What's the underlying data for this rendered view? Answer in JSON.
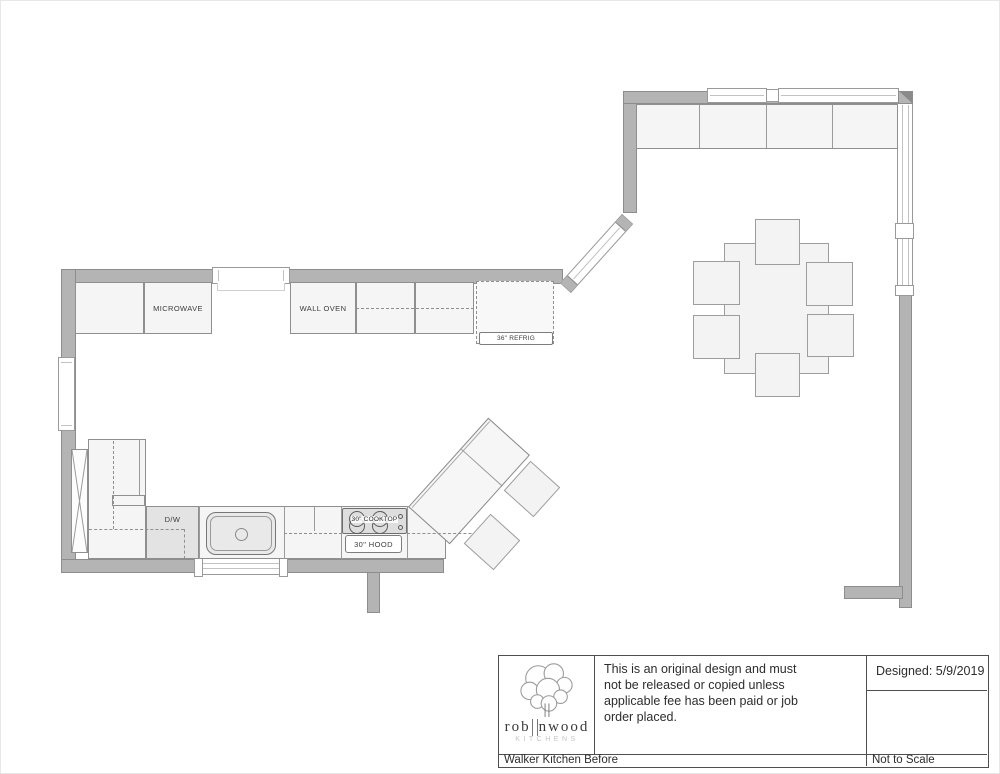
{
  "labels": {
    "microwave": "MICROWAVE",
    "wall_oven": "WALL OVEN",
    "refrig": "36\" REFRIG",
    "dishwasher": "D/W",
    "cooktop": "30\" COOKTOP",
    "hood": "30\" HOOD"
  },
  "title_block": {
    "disclaimer": "This is an original design and must\nnot be released or copied unless\napplicable fee has been paid or job\norder placed.",
    "designed_label": "Designed: 5/9/2019",
    "project_name": "Walker Kitchen Before",
    "scale_note": "Not to Scale",
    "logo": {
      "name_left": "rob",
      "name_right": "nwood",
      "subtitle": "KITCHENS"
    }
  },
  "colors": {
    "wall_fill": "#b4b4b4",
    "wall_border": "#8d8d8d",
    "cabinet_fill": "#f5f5f5",
    "cabinet_border": "#8f8f8f",
    "appliance_fill": "#dedede",
    "dashed_line": "#8f8f8f",
    "title_border": "#4f4f4f"
  }
}
